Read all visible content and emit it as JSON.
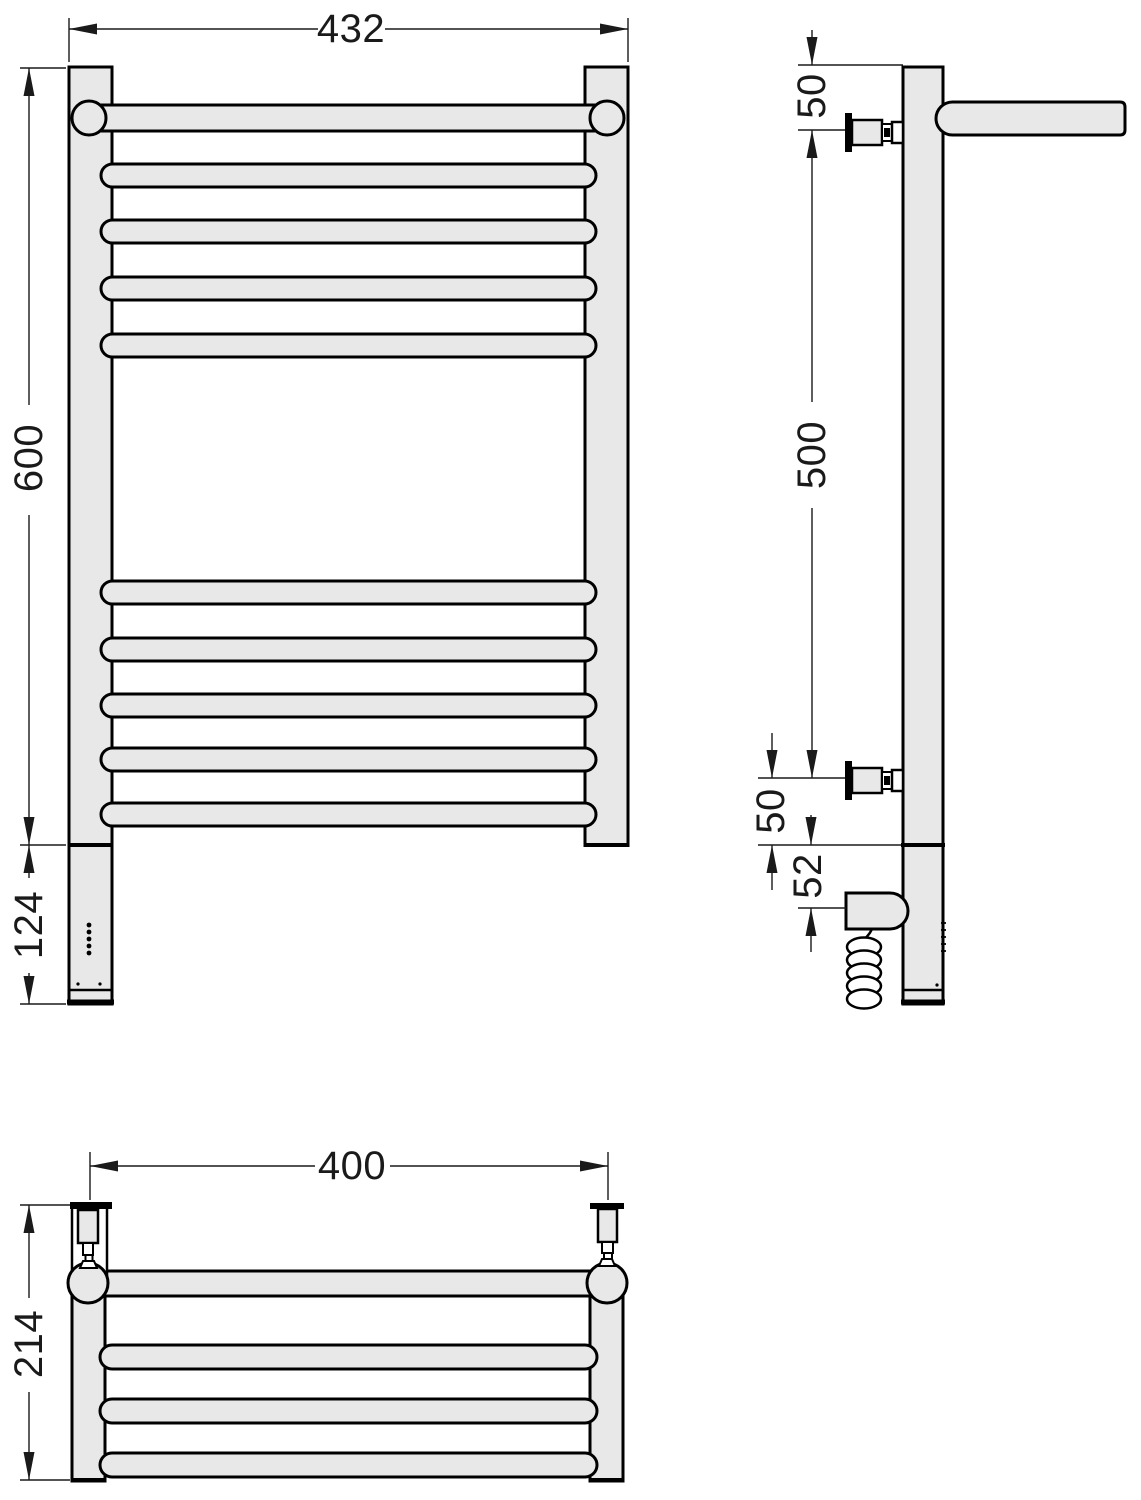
{
  "colors": {
    "bg": "#ffffff",
    "white": "#ffffff",
    "fill_gray": "#e8e8e8",
    "line_black": "#000000",
    "dim_gray": "#1a1a1a"
  },
  "dimensions": {
    "front_width_mm": "432",
    "front_height_mm": "600",
    "heating_element_height_mm": "124",
    "side_top_to_bracket_mm": "50",
    "side_bracket_span_mm": "500",
    "side_bracket_to_base_mm": "50",
    "side_element_offset_mm": "52",
    "top_mount_span_mm": "400",
    "top_depth_mm": "214"
  }
}
